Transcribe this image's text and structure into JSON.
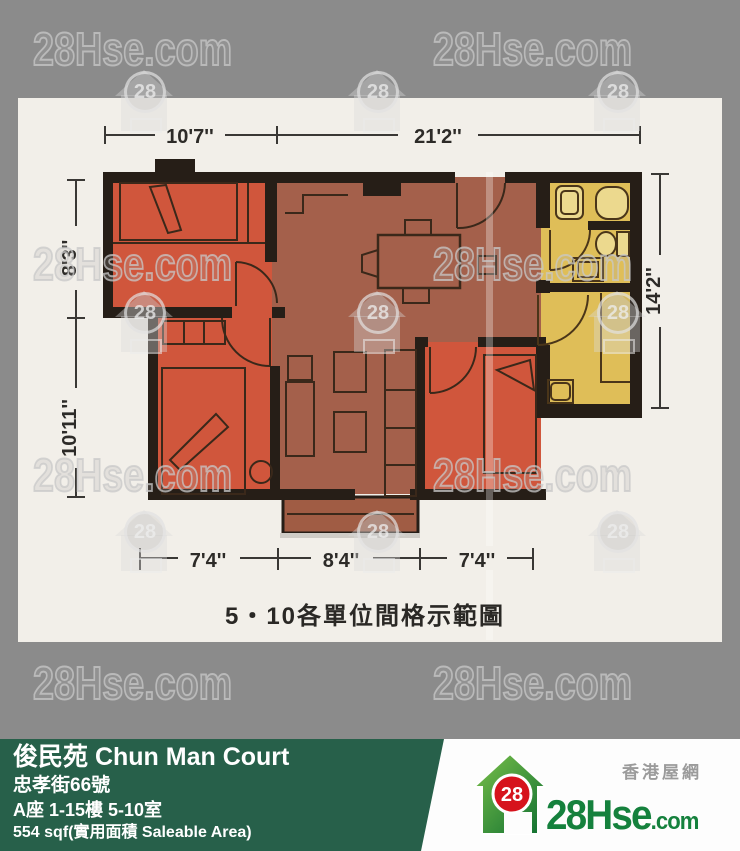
{
  "watermark": {
    "text": "28Hse.com",
    "badge": "28",
    "text_rows": [
      26,
      241,
      452,
      660
    ],
    "text_cols": [
      33,
      433
    ],
    "badge_rows": [
      66,
      287,
      506
    ],
    "badge_cols": [
      115,
      348,
      588
    ]
  },
  "floor_plan": {
    "caption": "5・10各單位間格示範圖",
    "dims": {
      "top1": "10'7''",
      "top2": "21'2''",
      "left1": "8'3''",
      "left2": "10'11''",
      "right1": "14'2''",
      "bottom1": "7'4''",
      "bottom2": "8'4''",
      "bottom3": "7'4''"
    }
  },
  "info_bar": {
    "title": "俊民苑 Chun Man Court",
    "address": "忠孝街66號",
    "unit": "A座 1-15樓 5-10室",
    "area": "554 sqf(實用面積 Saleable Area)",
    "bg_color": "#27604a"
  },
  "logo": {
    "badge": "28",
    "name_main": "28Hse",
    "name_suffix": ".com",
    "tagline": "香港屋網",
    "green": "#15813d",
    "red": "#d6131c"
  },
  "colors": {
    "background_gray": "#8b8b8b",
    "scan_paper": "#f2efe9",
    "bedroom_orange": "#d0563c",
    "living_brick": "#a4604b",
    "kitchen_yellow": "#dfbe58",
    "wall_black": "#261e17"
  }
}
